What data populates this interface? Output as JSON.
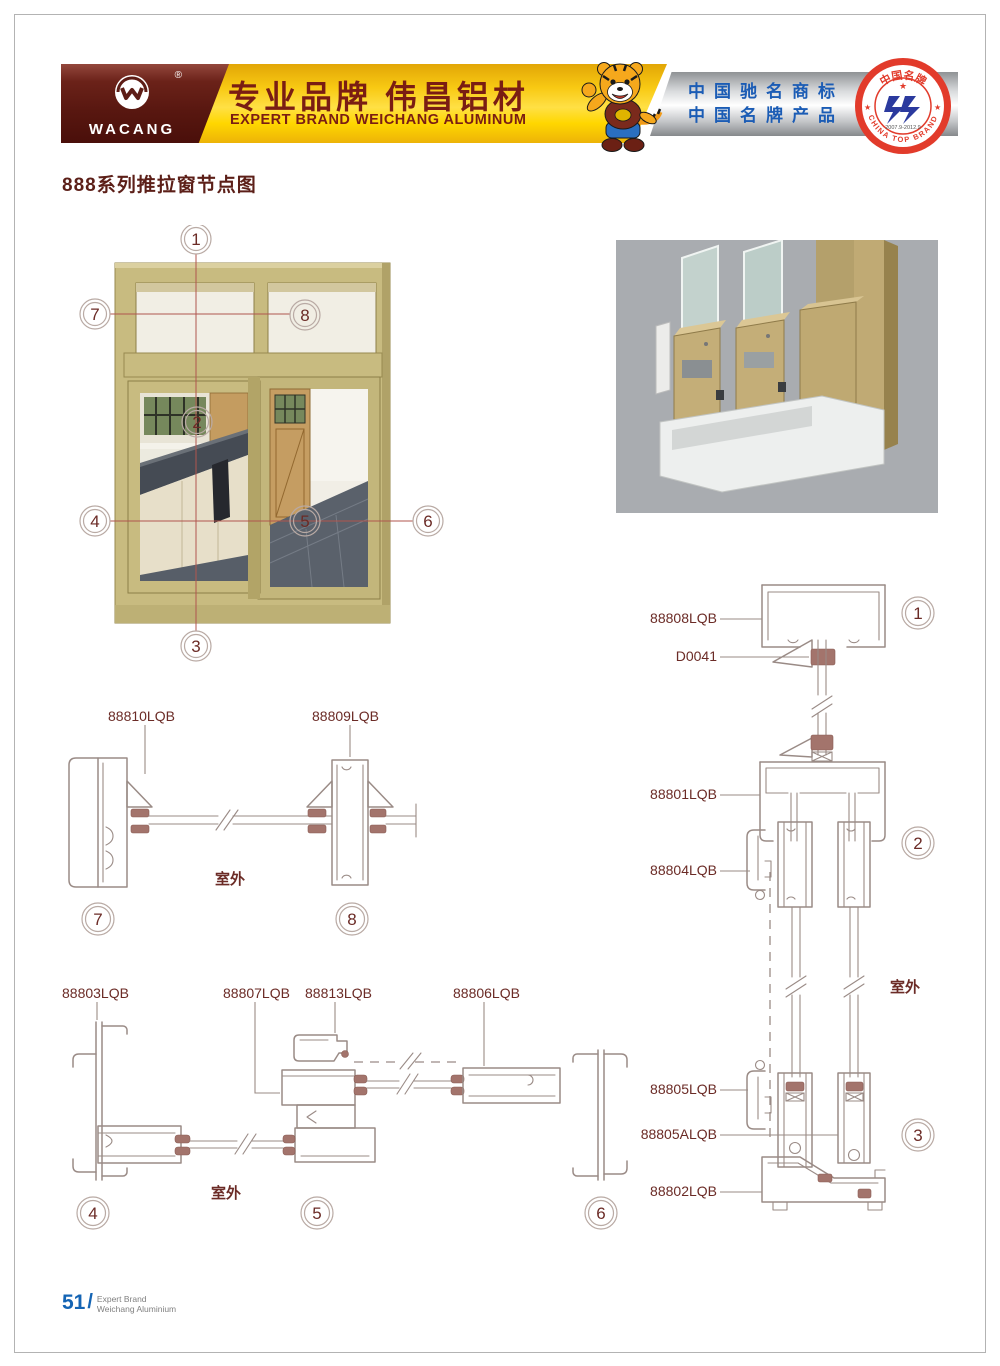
{
  "header": {
    "logo": {
      "text": "WACANG",
      "reg": "®"
    },
    "banner": {
      "cn": "专业品牌  伟昌铝材",
      "en": "EXPERT BRAND WEICHANG ALUMINUM"
    },
    "honors": {
      "line1": "中国驰名商标",
      "line2": "中国名牌产品"
    },
    "badge": {
      "top": "中国名牌",
      "bottom": "CHINA TOP BRAND",
      "dates": "2007.9-2012.9",
      "star": "★",
      "star_left": "★",
      "star_right": "★"
    }
  },
  "title": "888系列推拉窗节点图",
  "window_figure": {
    "callouts": {
      "c1": "1",
      "c2": "2",
      "c3": "3",
      "c4": "4",
      "c5": "5",
      "c6": "6",
      "c7": "7",
      "c8": "8"
    }
  },
  "drawings": {
    "d78": {
      "l88810": "88810LQB",
      "l88809": "88809LQB",
      "outdoor": "室外",
      "c7": "7",
      "c8": "8"
    },
    "d456": {
      "l88803": "88803LQB",
      "l88807": "88807LQB",
      "l88813": "88813LQB",
      "l88806": "88806LQB",
      "outdoor": "室外",
      "c4": "4",
      "c5": "5",
      "c6": "6"
    },
    "d123": {
      "l88808": "88808LQB",
      "d0041": "D0041",
      "l88801": "88801LQB",
      "l88804": "88804LQB",
      "l88805": "88805LQB",
      "l88805a": "88805ALQB",
      "l88802": "88802LQB",
      "outdoor": "室外",
      "c1": "1",
      "c2": "2",
      "c3": "3"
    }
  },
  "footer": {
    "num": "51",
    "slash": "/",
    "line1": "Expert Brand",
    "line2": "Weichang Aluminium"
  },
  "colors": {
    "maroon": "#5e1d16",
    "label_text": "#6b2b26",
    "drawing_line": "#9a8b86",
    "accent_blue": "#1464b4",
    "banner_yellow": "#ffd700",
    "badge_red": "#e23b2b",
    "badge_blue": "#2b3a9e",
    "frame_khaki": "#c8bb80",
    "honors_blue": "#1b5cb5"
  }
}
